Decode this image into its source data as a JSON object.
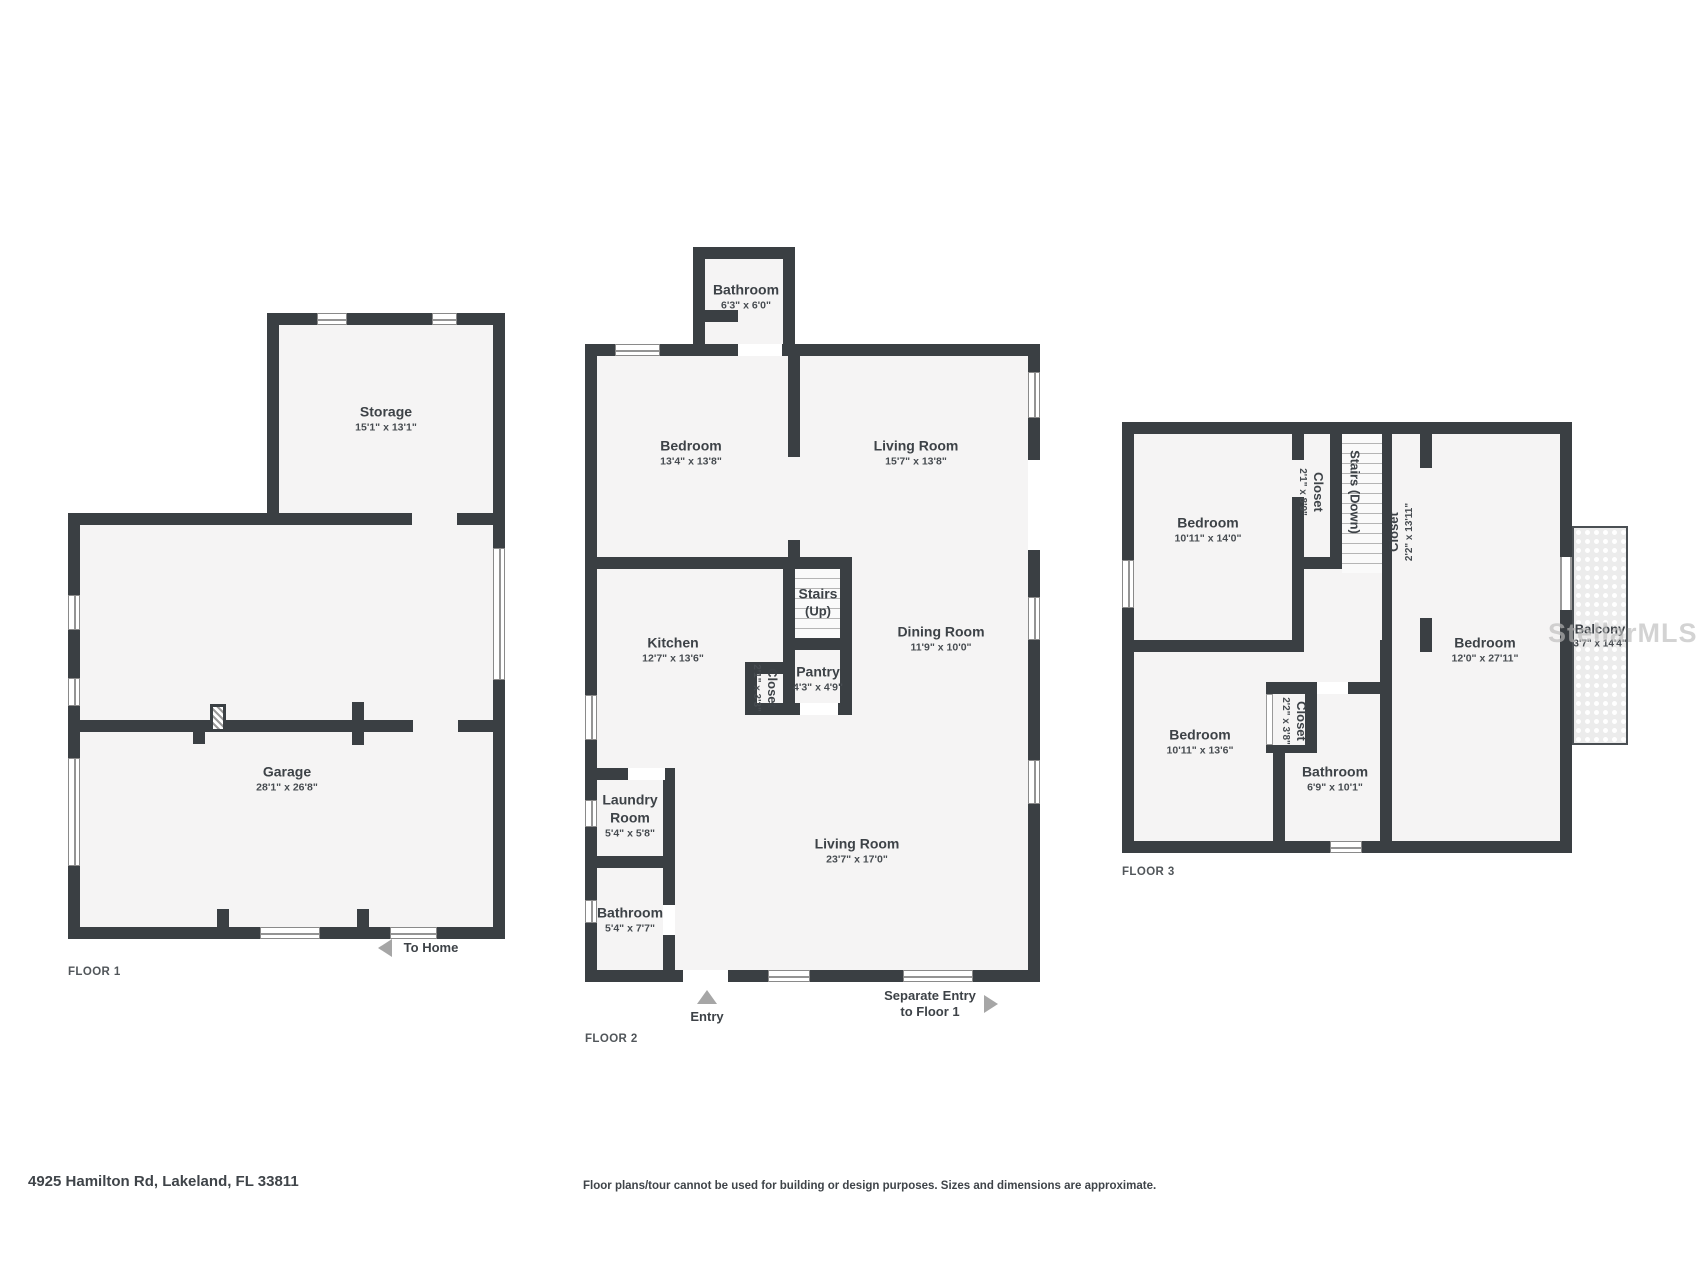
{
  "colors": {
    "wall": "#3a3f43",
    "room_fill": "#f5f4f4",
    "label": "#3d4247",
    "arrow": "#a6a6a6"
  },
  "watermark": "StellarMLS",
  "footer": {
    "address": "4925 Hamilton Rd, Lakeland, FL 33811",
    "disclaimer": "Floor plans/tour cannot be used for building or design purposes. Sizes and dimensions are approximate."
  },
  "floors": [
    {
      "label": "FLOOR 1",
      "rooms": {
        "storage": {
          "name": "Storage",
          "dims": "15'1\" x 13'1\""
        },
        "garage": {
          "name": "Garage",
          "dims": "28'1\" x 26'8\""
        }
      },
      "annotations": {
        "to_home": "To Home"
      }
    },
    {
      "label": "FLOOR 2",
      "rooms": {
        "bathroom_top": {
          "name": "Bathroom",
          "dims": "6'3\" x 6'0\""
        },
        "bedroom": {
          "name": "Bedroom",
          "dims": "13'4\" x 13'8\""
        },
        "living_upper": {
          "name": "Living Room",
          "dims": "15'7\" x 13'8\""
        },
        "kitchen": {
          "name": "Kitchen",
          "dims": "12'7\" x 13'6\""
        },
        "stairs": {
          "name": "Stairs",
          "dims": "(Up)"
        },
        "closet": {
          "name": "Closet",
          "dims": "2'1\" x 3'3\""
        },
        "pantry": {
          "name": "Pantry",
          "dims": "4'3\" x 4'9\""
        },
        "dining": {
          "name": "Dining Room",
          "dims": "11'9\" x 10'0\""
        },
        "laundry": {
          "name_line1": "Laundry",
          "name_line2": "Room",
          "dims": "5'4\" x 5'8\""
        },
        "bathroom_lower": {
          "name": "Bathroom",
          "dims": "5'4\" x 7'7\""
        },
        "living_lower": {
          "name": "Living Room",
          "dims": "23'7\" x 17'0\""
        }
      },
      "annotations": {
        "entry": "Entry",
        "separate_entry_line1": "Separate Entry",
        "separate_entry_line2": "to Floor 1"
      }
    },
    {
      "label": "FLOOR 3",
      "rooms": {
        "bedroom_top": {
          "name": "Bedroom",
          "dims": "10'11\" x 14'0\""
        },
        "closet_top": {
          "name": "Closet",
          "dims": "2'1\" x 8'9\""
        },
        "stairs": {
          "name": "Stairs (Down)"
        },
        "closet_long": {
          "name": "Closet",
          "dims": "2'2\" x 13'11\""
        },
        "bedroom_right": {
          "name": "Bedroom",
          "dims": "12'0\" x 27'11\""
        },
        "balcony": {
          "name": "Balcony",
          "dims": "3'7\" x 14'4\""
        },
        "bedroom_bottom": {
          "name": "Bedroom",
          "dims": "10'11\" x 13'6\""
        },
        "closet_small": {
          "name": "Closet",
          "dims": "2'2\" x 3'8\""
        },
        "bathroom": {
          "name": "Bathroom",
          "dims": "6'9\" x 10'1\""
        }
      }
    }
  ]
}
